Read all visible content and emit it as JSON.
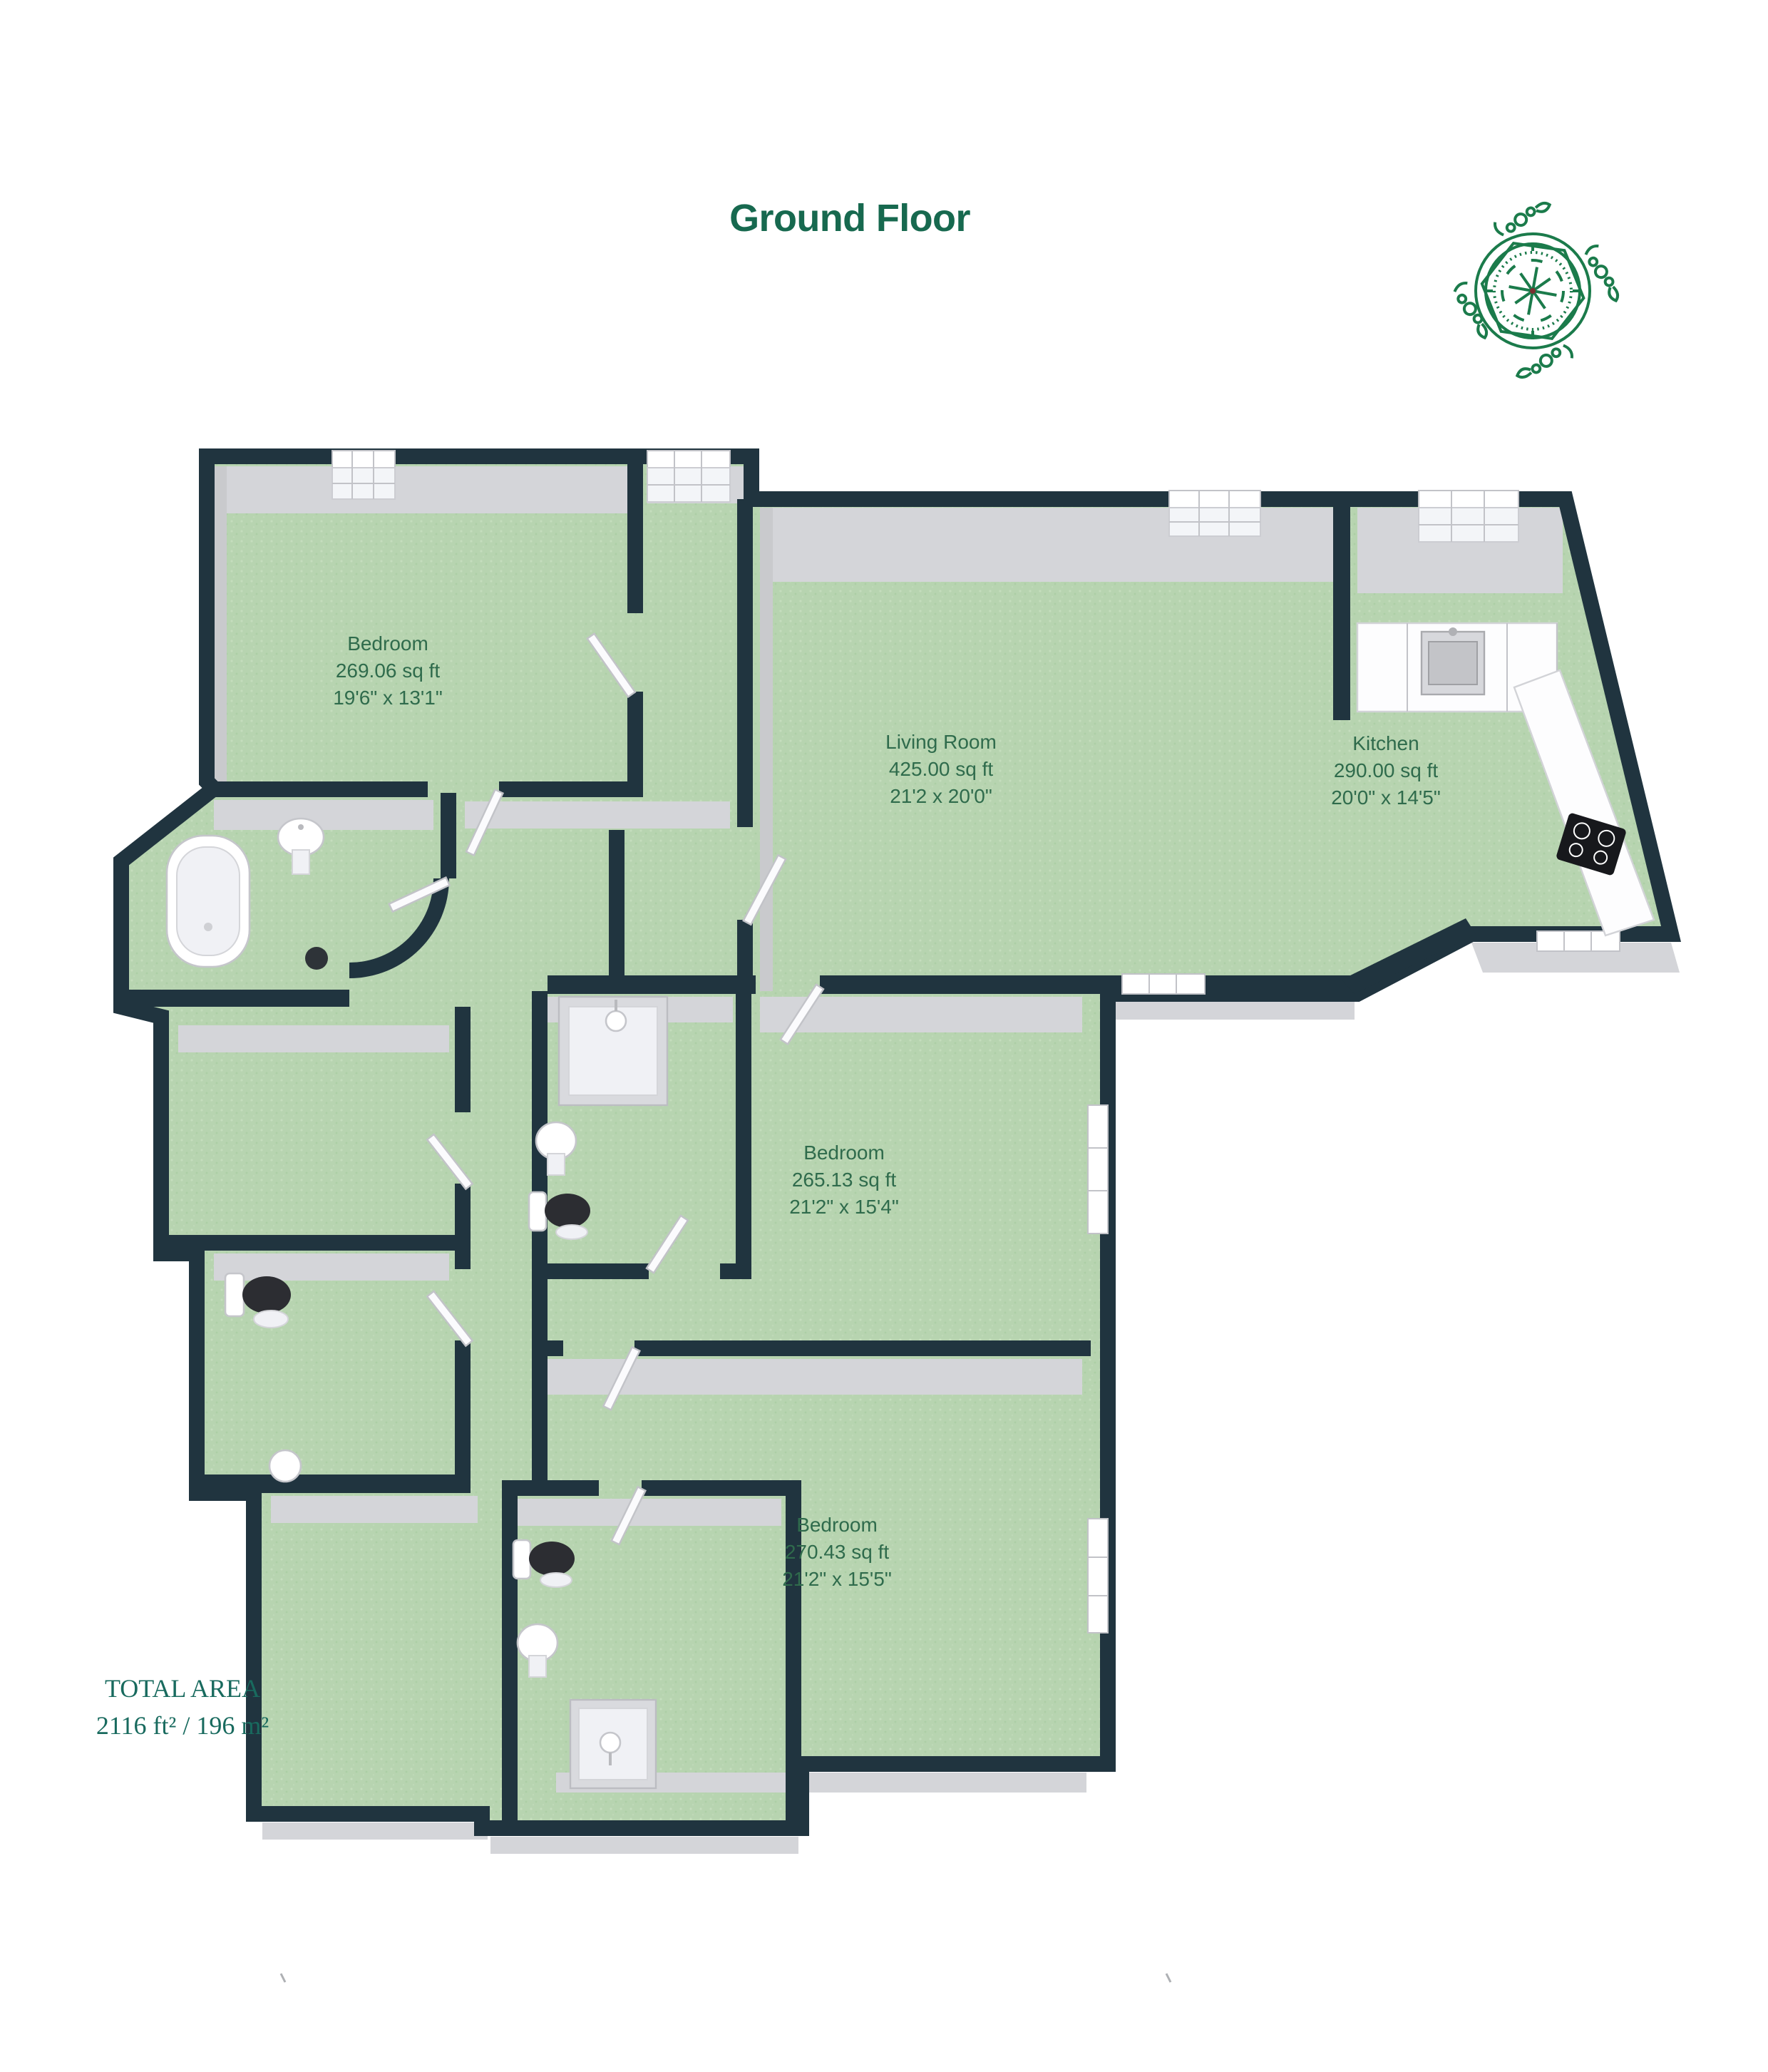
{
  "title": "Ground Floor",
  "logo": {
    "icon": "compass-rose-logo",
    "color": "#1b7b4b"
  },
  "rooms": [
    {
      "id": "bedroom-1",
      "name": "Bedroom",
      "area": "269.06 sq ft",
      "dims": "19'6\" x 13'1\""
    },
    {
      "id": "living-room",
      "name": "Living  Room",
      "area": "425.00 sq ft",
      "dims": "21'2 x 20'0\""
    },
    {
      "id": "kitchen",
      "name": "Kitchen",
      "area": "290.00 sq ft",
      "dims": "20'0\" x 14'5\""
    },
    {
      "id": "bedroom-2",
      "name": "Bedroom",
      "area": "265.13 sq ft",
      "dims": "21'2\" x 15'4\""
    },
    {
      "id": "bedroom-3",
      "name": "Bedroom",
      "area": "270.43 sq ft",
      "dims": "21'2\" x 15'5\""
    }
  ],
  "total_area": {
    "label": "TOTAL AREA",
    "value": "2116 ft² / 196 m²"
  },
  "fixtures": [
    "bathtub",
    "pedestal-sink",
    "toilet",
    "shower",
    "kitchen-sink",
    "hob",
    "window",
    "door"
  ],
  "colors": {
    "wall": "#20343f",
    "floor": "#b7d4b0",
    "wall_face": "#d4d5d9",
    "accent_text": "#2f6b4c",
    "title": "#17694f",
    "total": "#186a5e",
    "logo": "#1b7b4b"
  }
}
